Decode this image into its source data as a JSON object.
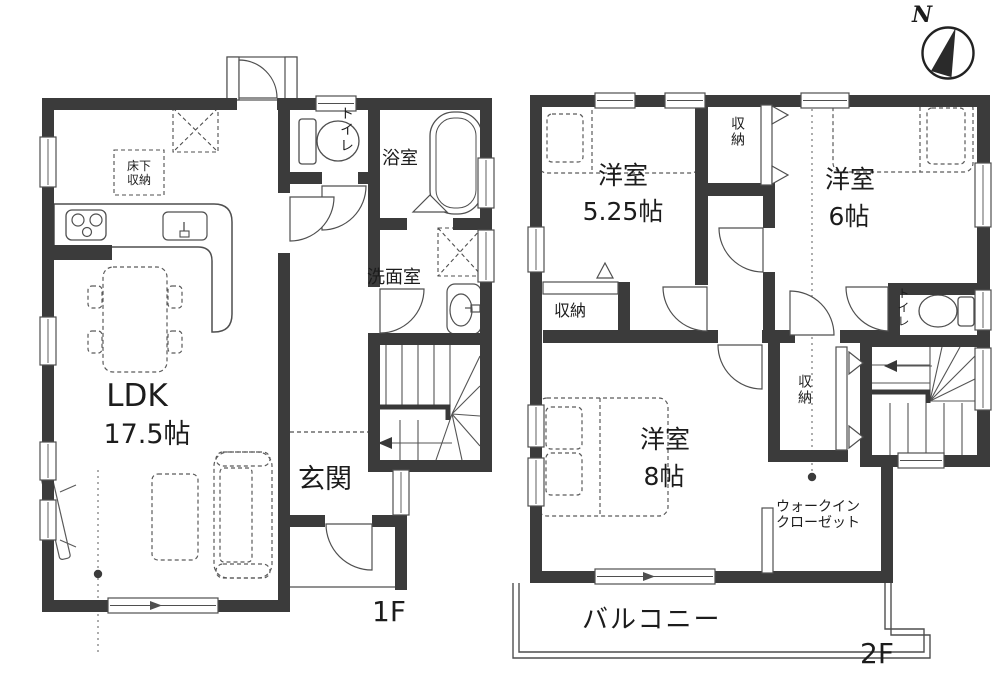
{
  "compass": {
    "north_label": "N"
  },
  "floor_1f": {
    "floor_label": "1F",
    "ldk": {
      "name": "LDK",
      "size": "17.5帖"
    },
    "entrance": "玄関",
    "toilet": "トイレ",
    "bathroom": "浴室",
    "washroom": "洗面室",
    "underfloor_storage": {
      "line1": "床下",
      "line2": "収納"
    }
  },
  "floor_2f": {
    "floor_label": "2F",
    "bedroom_525": {
      "name": "洋室",
      "size": "5.25帖"
    },
    "bedroom_6": {
      "name": "洋室",
      "size": "6帖"
    },
    "bedroom_8": {
      "name": "洋室",
      "size": "8帖"
    },
    "storage_top": "収納",
    "storage_left": "収納",
    "storage_mid": "収納",
    "toilet": "トイレ",
    "walkin_closet": {
      "line1": "ウォークイン",
      "line2": "クローゼット"
    },
    "balcony": "バルコニー"
  },
  "colors": {
    "wall": "#3b3b3b",
    "line": "#4f4f4f",
    "text": "#1c1c1c",
    "bg": "#ffffff"
  }
}
